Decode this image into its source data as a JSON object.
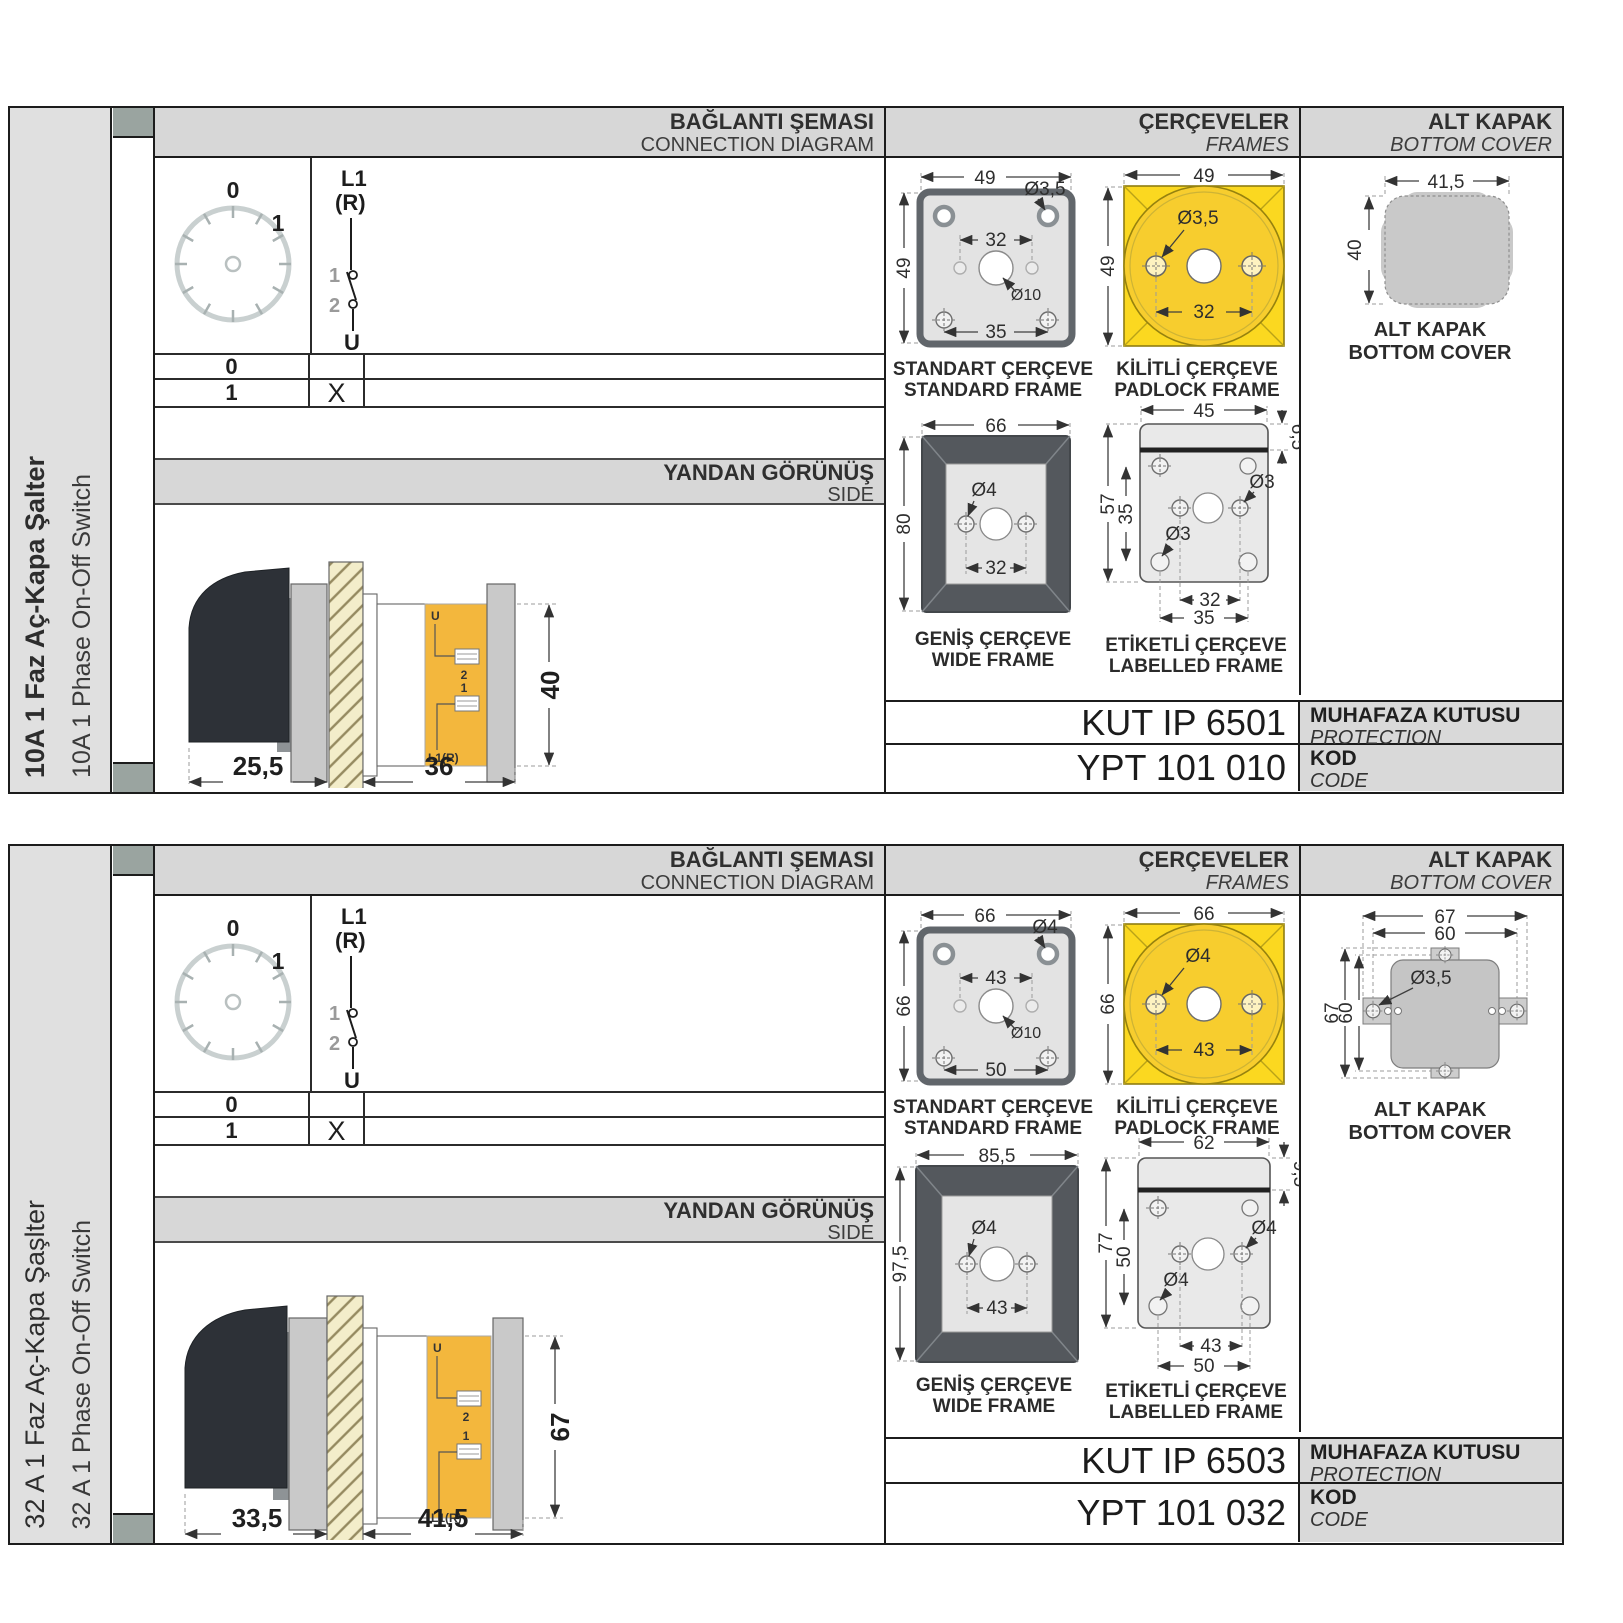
{
  "colors": {
    "border": "#1c1c1c",
    "header_gray": "#d7d7d7",
    "sidebar_gray": "#e0e0e0",
    "tab_square": "#9aa4a0",
    "padlock_yellow": "#fbd820",
    "terminal_yellow": "#f3b73d",
    "wide_frame_dark": "#54585d",
    "cover_gray": "#c9c9c9"
  },
  "sections": [
    {
      "sidebar": {
        "title": "10A 1 Faz Aç-Kapa Şalter",
        "subtitle": "10A 1 Phase On-Off Switch"
      },
      "headers": {
        "connection": {
          "tr": "BAĞLANTI ŞEMASI",
          "en": "CONNECTION DIAGRAM"
        },
        "frames": {
          "tr": "ÇERÇEVELER",
          "en": "FRAMES"
        },
        "cover": {
          "tr": "ALT KAPAK",
          "en": "BOTTOM COVER"
        },
        "side": {
          "tr": "YANDAN GÖRÜNÜŞ",
          "en": "SIDE"
        }
      },
      "connection": {
        "dial": {
          "p0": "0",
          "p1": "1"
        },
        "sw": {
          "l1": "L1",
          "r": "(R)",
          "c1": "1",
          "c2": "2",
          "u": "U"
        },
        "rows": [
          {
            "pos": "0",
            "mark": ""
          },
          {
            "pos": "1",
            "mark": "X"
          }
        ]
      },
      "side_view": {
        "u": "U",
        "t2": "2",
        "t1": "1",
        "l1r": "L1(R)",
        "d1": "25,5",
        "d2": "36",
        "dh": "40"
      },
      "frames": {
        "standard": {
          "tr": "STANDART ÇERÇEVE",
          "en": "STANDARD FRAME",
          "w": "49",
          "h": "49",
          "inner": "32",
          "lower": "35",
          "hole": "Ø3,5",
          "center": "Ø10"
        },
        "padlock": {
          "tr": "KİLİTLİ ÇERÇEVE",
          "en": "PADLOCK FRAME",
          "w": "49",
          "h": "49",
          "hole": "Ø3,5",
          "inner": "32"
        },
        "wide": {
          "tr": "GENİŞ ÇERÇEVE",
          "en": "WIDE FRAME",
          "w": "66",
          "h": "80",
          "hole": "Ø4",
          "inner": "32"
        },
        "labelled": {
          "tr": "ETİKETLİ ÇERÇEVE",
          "en": "LABELLED FRAME",
          "w": "45",
          "band": "6,5",
          "h": "57",
          "innerh": "35",
          "hole_u": "Ø3",
          "hole_l": "Ø3",
          "b1": "32",
          "b2": "35"
        }
      },
      "cover": {
        "tr": "ALT KAPAK",
        "en": "BOTTOM COVER",
        "w": "41,5",
        "h": "40"
      },
      "enclosure": {
        "code": "KUT IP 6501",
        "tr": "MUHAFAZA KUTUSU",
        "en": "PROTECTION ENCLOSURE"
      },
      "code": {
        "code": "YPT 101 010",
        "tr": "KOD",
        "en": "CODE"
      }
    },
    {
      "sidebar": {
        "title": "32 A 1 Faz Aç-Kapa Şaşlter",
        "subtitle": "32 A 1 Phase On-Off Switch"
      },
      "headers": {
        "connection": {
          "tr": "BAĞLANTI ŞEMASI",
          "en": "CONNECTION DIAGRAM"
        },
        "frames": {
          "tr": "ÇERÇEVELER",
          "en": "FRAMES"
        },
        "cover": {
          "tr": "ALT KAPAK",
          "en": "BOTTOM COVER"
        },
        "side": {
          "tr": "YANDAN GÖRÜNÜŞ",
          "en": "SIDE"
        }
      },
      "connection": {
        "dial": {
          "p0": "0",
          "p1": "1"
        },
        "sw": {
          "l1": "L1",
          "r": "(R)",
          "c1": "1",
          "c2": "2",
          "u": "U"
        },
        "rows": [
          {
            "pos": "0",
            "mark": ""
          },
          {
            "pos": "1",
            "mark": "X"
          }
        ]
      },
      "side_view": {
        "u": "U",
        "t2": "2",
        "t1": "1",
        "l1r": "L1(R)",
        "d1": "33,5",
        "d2": "41,5",
        "dh": "67"
      },
      "frames": {
        "standard": {
          "tr": "STANDART ÇERÇEVE",
          "en": "STANDARD FRAME",
          "w": "66",
          "h": "66",
          "inner": "43",
          "lower": "50",
          "hole": "Ø4",
          "center": "Ø10"
        },
        "padlock": {
          "tr": "KİLİTLİ ÇERÇEVE",
          "en": "PADLOCK FRAME",
          "w": "66",
          "h": "66",
          "hole": "Ø4",
          "inner": "43"
        },
        "wide": {
          "tr": "GENİŞ ÇERÇEVE",
          "en": "WIDE FRAME",
          "w": "85,5",
          "h": "97,5",
          "hole": "Ø4",
          "inner": "43"
        },
        "labelled": {
          "tr": "ETİKETLİ ÇERÇEVE",
          "en": "LABELLED FRAME",
          "w": "62",
          "band": "9,5",
          "h": "77",
          "innerh": "50",
          "hole_u": "Ø4",
          "hole_l": "Ø4",
          "b1": "43",
          "b2": "50"
        }
      },
      "cover": {
        "tr": "ALT KAPAK",
        "en": "BOTTOM COVER",
        "w1": "67",
        "w2": "60",
        "h1": "67",
        "h2": "60",
        "hole": "Ø3,5"
      },
      "enclosure": {
        "code": "KUT IP 6503",
        "tr": "MUHAFAZA KUTUSU",
        "en": "PROTECTION ENCLOSURE"
      },
      "code": {
        "code": "YPT 101 032",
        "tr": "KOD",
        "en": "CODE"
      }
    }
  ]
}
